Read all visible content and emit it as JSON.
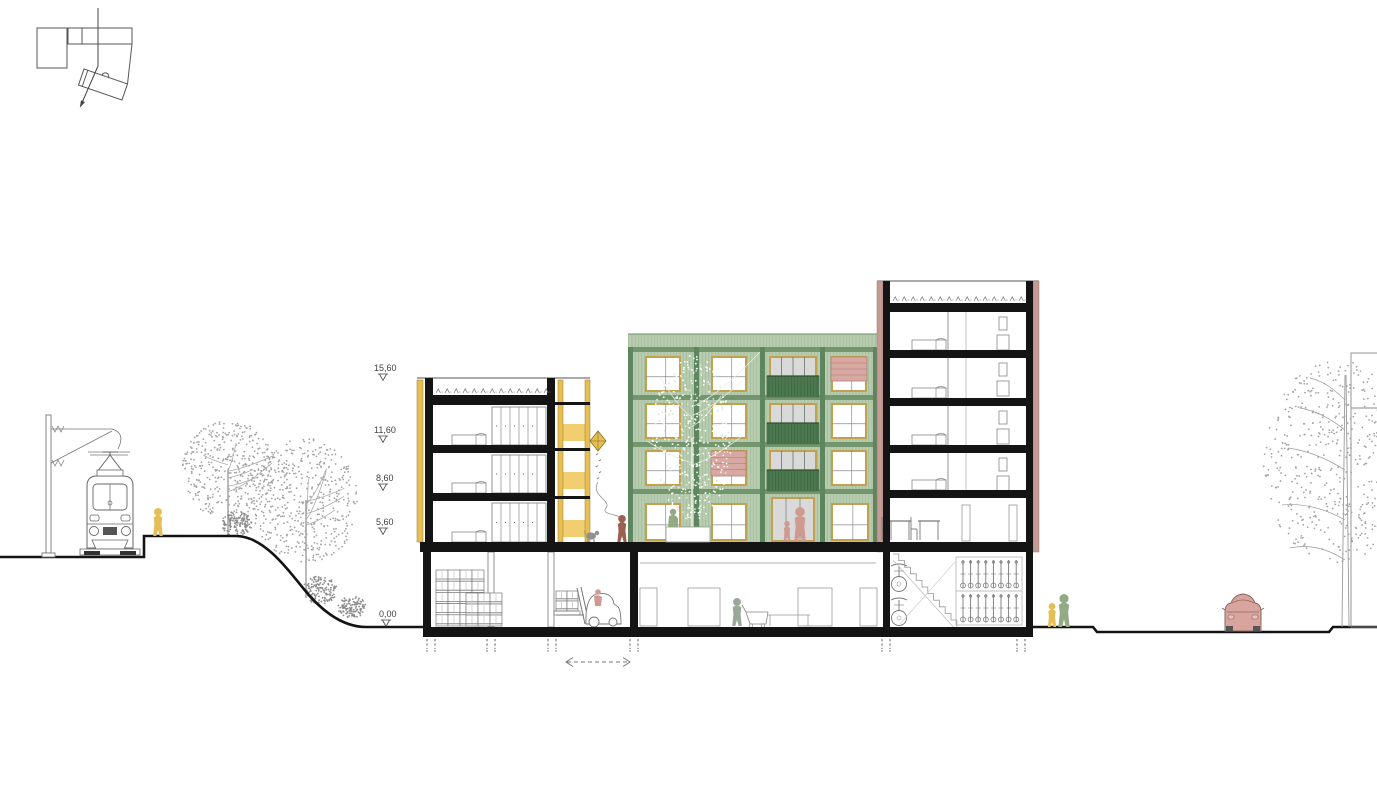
{
  "scene": {
    "elevation_markers": [
      {
        "label": "15,60"
      },
      {
        "label": "11,60"
      },
      {
        "label": "8,60"
      },
      {
        "label": "5,60"
      },
      {
        "label": "0,00"
      }
    ]
  },
  "colors": {
    "ink": "#141414",
    "line": "#6e6e6e",
    "line_light": "#9a9a9a",
    "yellow": "#e5bf54",
    "yellow_band": "#f1cf70",
    "yellow_edge": "#9c7d26",
    "green_light": "#b9cdb0",
    "green_mid": "#74966f",
    "green_dark": "#5e865e",
    "green_rail": "#4c7950",
    "tan": "#c2a14e",
    "pink": "#c49b94",
    "pink_edge": "#9e7b74",
    "awning": "#d8a8a2",
    "glass": "#d9d9d9",
    "car": "#d9a49e",
    "car_edge": "#8a6560",
    "figure_yellow": "#e5bf54",
    "figure_green": "#93ab85",
    "figure_salmon": "#cf9a8f",
    "figure_brown": "#9c604f",
    "figure_gray": "#9aa79b",
    "tree_dot": "#a3a3a3",
    "tree_dot_dark": "#8d8d8d",
    "tree_white": "#ffffff",
    "tree_white_tint": "#d9e6d2",
    "trunk_white": "#e9efe5"
  }
}
